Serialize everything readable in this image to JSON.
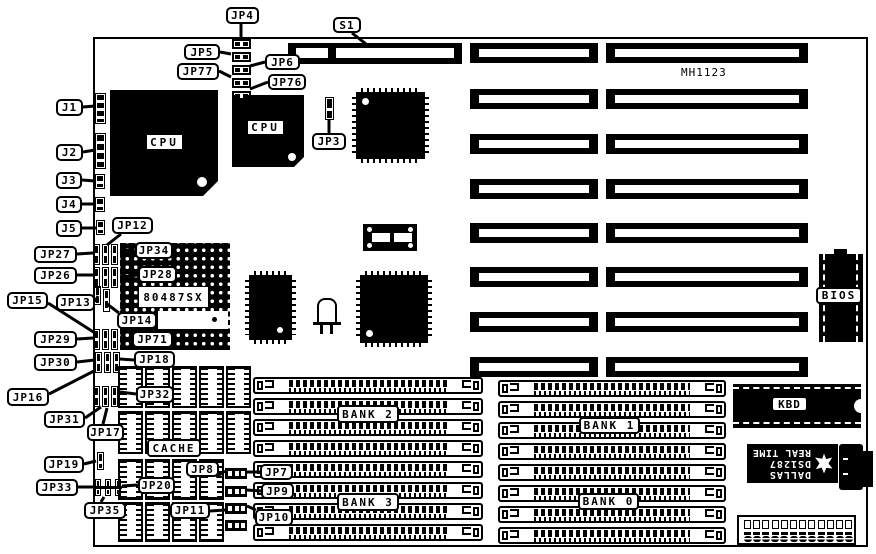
{
  "board": {
    "silkscreen": "MH1123"
  },
  "palette": {
    "ink": "#000000",
    "paper": "#ffffff"
  },
  "chips": {
    "cpu_primary": "CPU",
    "cpu_secondary": "CPU",
    "coprocessor_socket": "80487SX",
    "cache": "CACHE",
    "bios": "BIOS",
    "keyboard_controller": "KBD",
    "rtc": {
      "brand": "DALLAS",
      "part": "DS1287",
      "line": "REAL TIME"
    }
  },
  "memory_banks": [
    {
      "label": "BANK 2"
    },
    {
      "label": "BANK 1"
    },
    {
      "label": "BANK 3"
    },
    {
      "label": "BANK 0"
    }
  ],
  "slots": {
    "isa_slot_rows": 8
  },
  "callouts": [
    {
      "label": "JP4"
    },
    {
      "label": "S1"
    },
    {
      "label": "JP5"
    },
    {
      "label": "JP6"
    },
    {
      "label": "JP77"
    },
    {
      "label": "JP76"
    },
    {
      "label": "JP3"
    },
    {
      "label": "J1"
    },
    {
      "label": "J2"
    },
    {
      "label": "J3"
    },
    {
      "label": "J4"
    },
    {
      "label": "J5"
    },
    {
      "label": "JP12"
    },
    {
      "label": "JP27"
    },
    {
      "label": "JP34"
    },
    {
      "label": "JP26"
    },
    {
      "label": "JP28"
    },
    {
      "label": "JP15"
    },
    {
      "label": "JP13"
    },
    {
      "label": "JP14"
    },
    {
      "label": "JP29"
    },
    {
      "label": "JP71"
    },
    {
      "label": "JP30"
    },
    {
      "label": "JP18"
    },
    {
      "label": "JP16"
    },
    {
      "label": "JP32"
    },
    {
      "label": "JP31"
    },
    {
      "label": "JP17"
    },
    {
      "label": "JP19"
    },
    {
      "label": "JP33"
    },
    {
      "label": "JP35"
    },
    {
      "label": "JP20"
    },
    {
      "label": "JP8"
    },
    {
      "label": "JP7"
    },
    {
      "label": "JP9"
    },
    {
      "label": "JP11"
    },
    {
      "label": "JP10"
    }
  ]
}
